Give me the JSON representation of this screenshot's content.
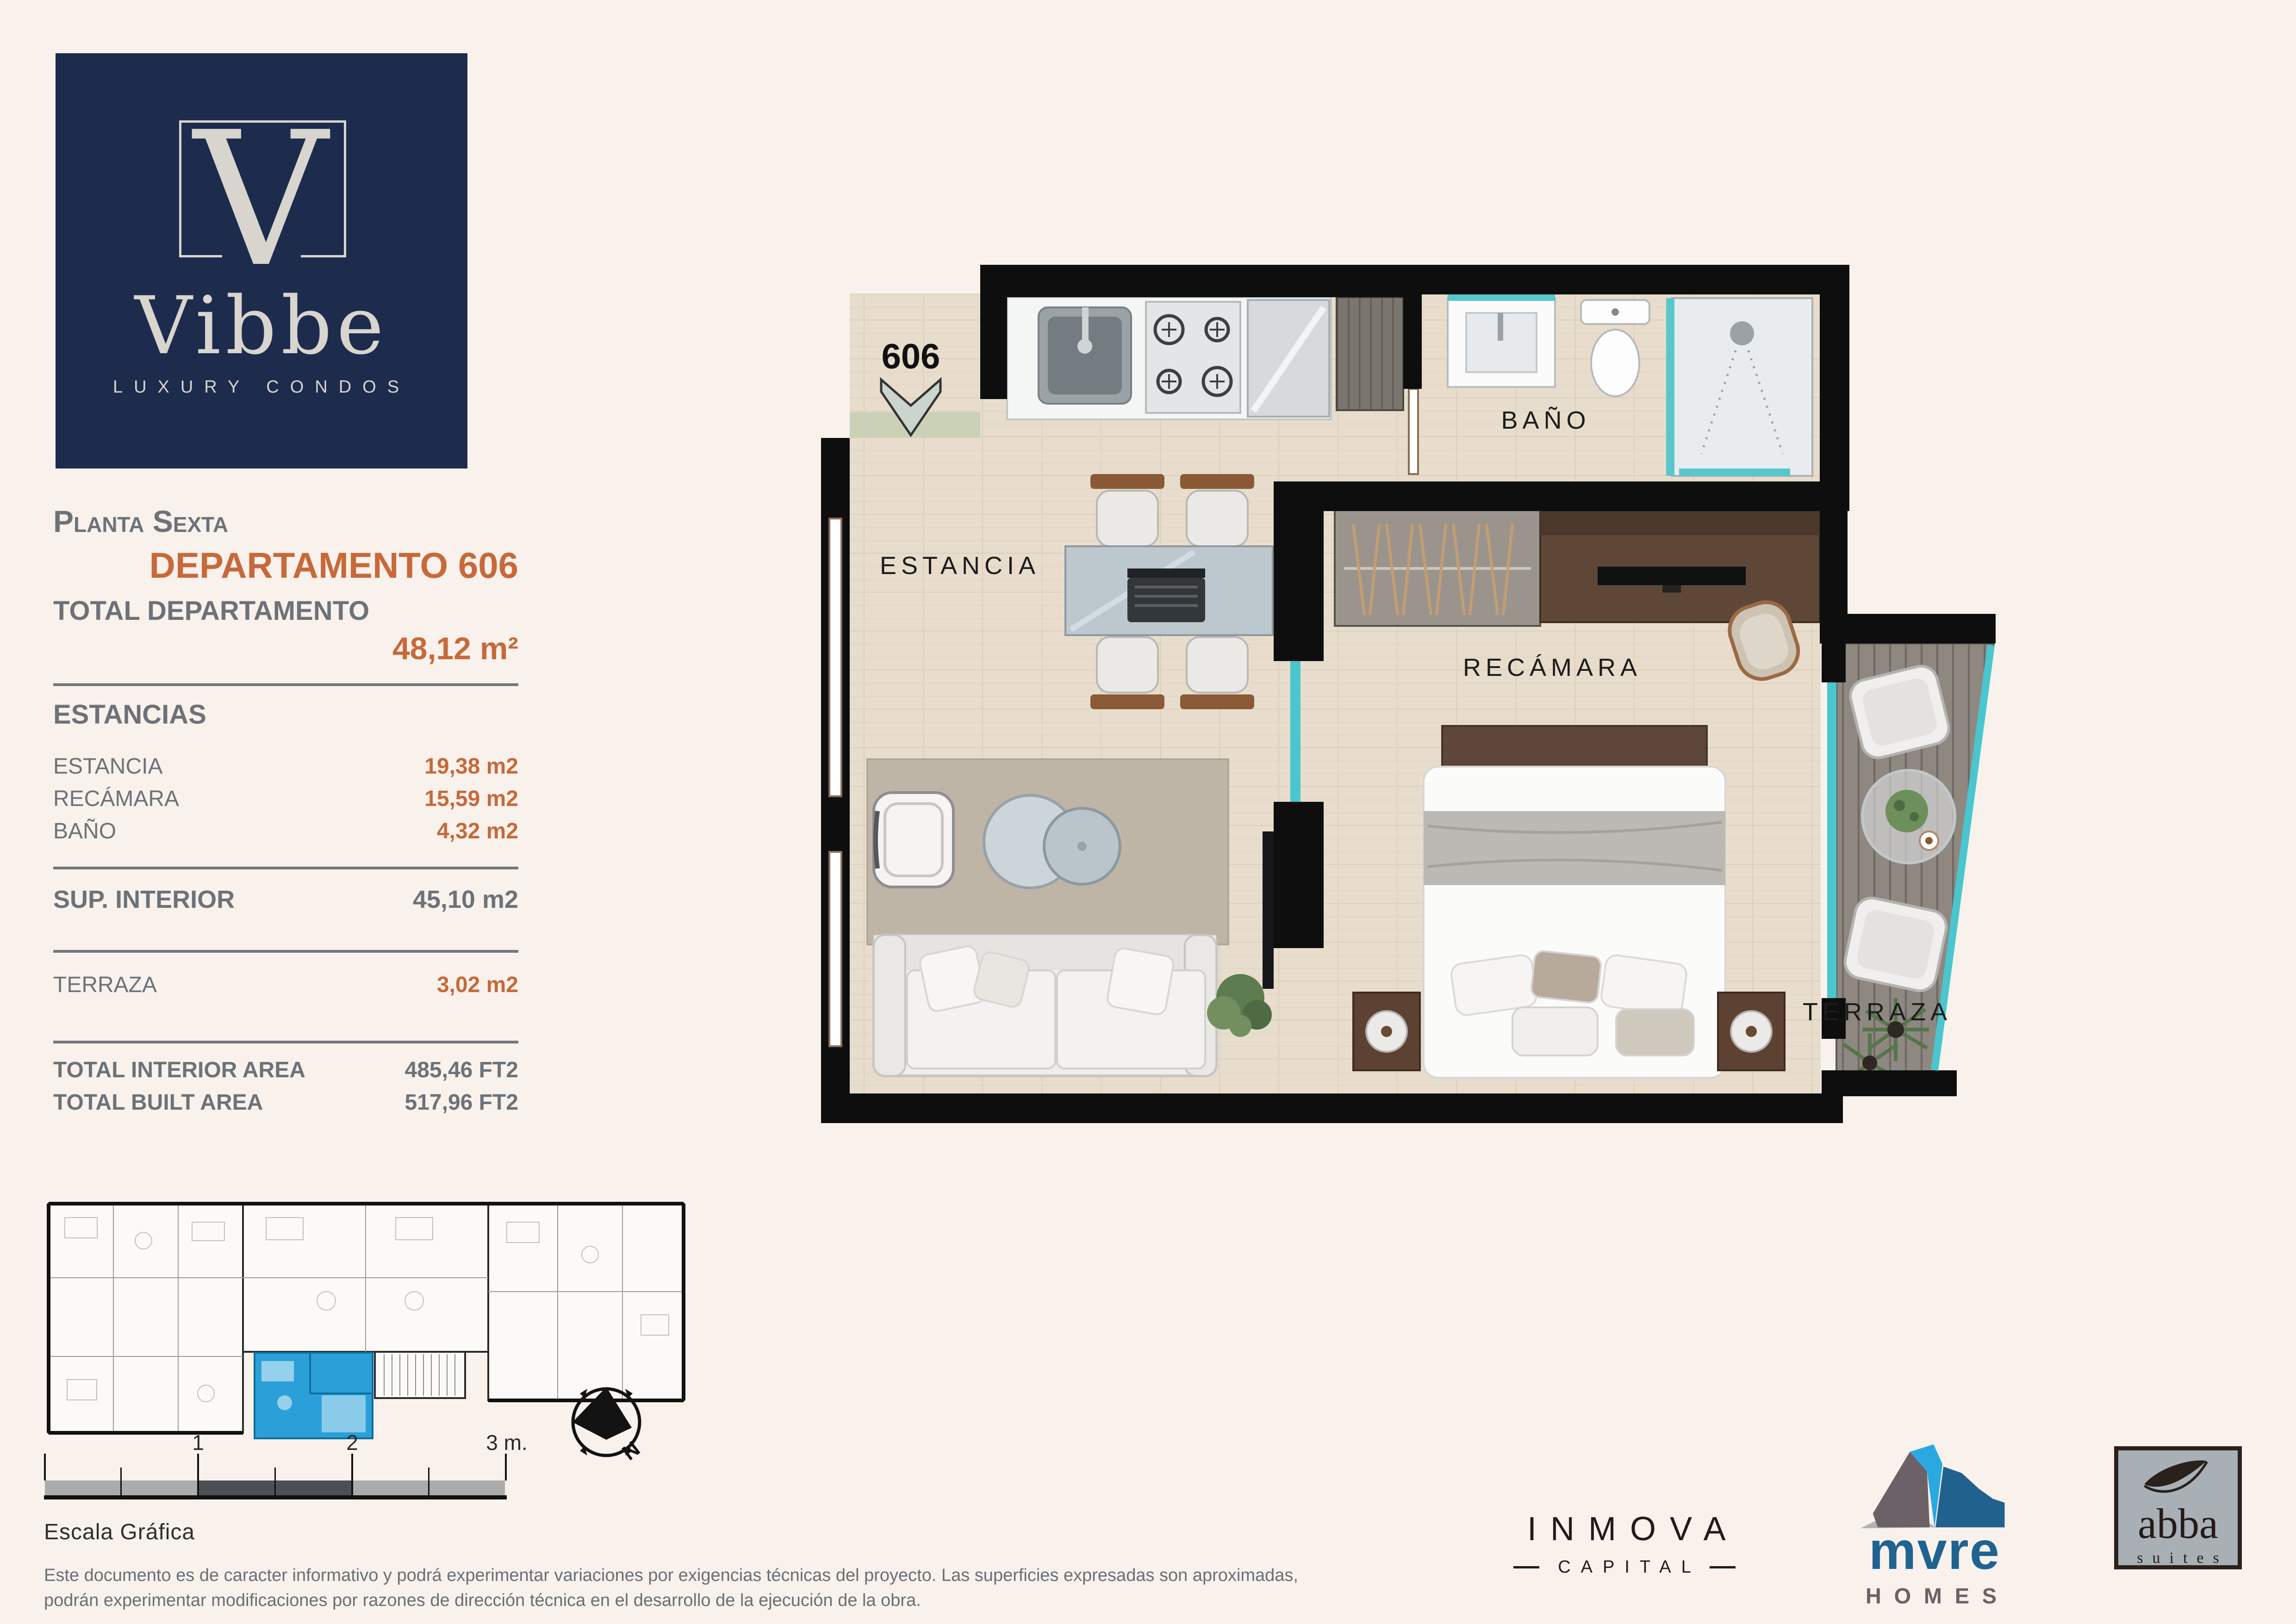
{
  "colors": {
    "background": "#f8f1ec",
    "brand_navy": "#1d2b4d",
    "accent_orange": "#c7693a",
    "text_gray": "#6d7278",
    "wall_black": "#0e0e0e",
    "highlight_blue": "#2ba0d8",
    "teal_glass": "#49c6ce"
  },
  "brand": {
    "monogram": "V",
    "name": "Vibbe",
    "tagline": "LUXURY CONDOS"
  },
  "panel": {
    "floor_title": "Planta Sexta",
    "unit_title": "DEPARTAMENTO 606",
    "total_label": "TOTAL DEPARTAMENTO",
    "total_value": "48,12 m²",
    "sections_label": "ESTANCIAS",
    "rooms": [
      {
        "label": "ESTANCIA",
        "value": "19,38 m2"
      },
      {
        "label": "RECÁMARA",
        "value": "15,59 m2"
      },
      {
        "label": "BAÑO",
        "value": "4,32 m2"
      }
    ],
    "interior": {
      "label": "SUP. INTERIOR",
      "value": "45,10 m2"
    },
    "terrace": {
      "label": "TERRAZA",
      "value": "3,02 m2"
    },
    "totals": [
      {
        "label": "TOTAL INTERIOR AREA",
        "value": "485,46 FT2"
      },
      {
        "label": "TOTAL BUILT AREA",
        "value": "517,96 FT2"
      }
    ]
  },
  "plan": {
    "unit_number": "606",
    "labels": {
      "estancia": "ESTANCIA",
      "bano": "BAÑO",
      "recamara": "RECÁMARA",
      "terraza": "TERRAZA"
    }
  },
  "scale_bar": {
    "tick_1": "1",
    "tick_2": "2",
    "tick_3": "3 m.",
    "label": "Escala Gráfica"
  },
  "compass": {
    "north_label": "N"
  },
  "disclaimer": {
    "line1": "Este documento es de caracter informativo y podrá experimentar variaciones por exigencias técnicas del proyecto. Las superficies expresadas son aproximadas,",
    "line2": "podrán experimentar modificaciones por razones de dirección técnica en el desarrollo de la ejecución de la obra."
  },
  "partners": {
    "inmova": {
      "name": "INMOVA",
      "sub": "CAPITAL"
    },
    "mure": {
      "name": "mvre",
      "sub": "HOMES"
    },
    "abba": {
      "name": "abba",
      "sub": "suites"
    }
  }
}
